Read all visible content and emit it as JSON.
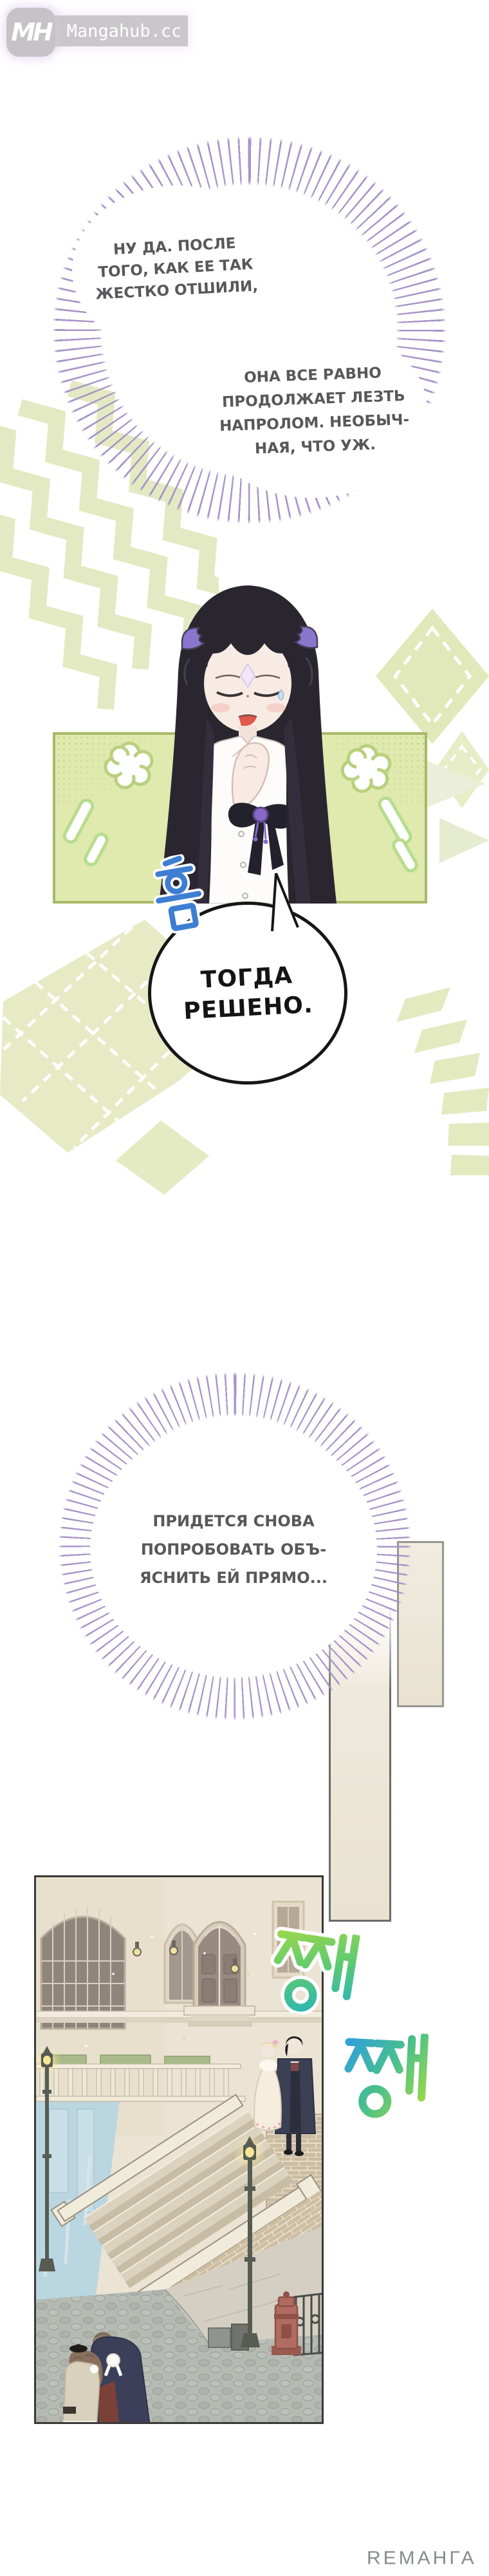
{
  "site_watermark": {
    "initials": "MH",
    "domain": "Mangahub.cc"
  },
  "bubbles": {
    "b1": {
      "lines": [
        "НУ ДА. ПОСЛЕ",
        "ТОГО, КАК ЕЕ ТАК",
        "ЖЕСТКО ОТШИЛИ,"
      ]
    },
    "b2": {
      "lines": [
        "ОНА ВСЕ РАВНО",
        "ПРОДОЛЖАЕТ ЛЕЗТЬ",
        "НАПРОЛОМ. НЕОБЫЧ-",
        "НАЯ, ЧТО УЖ."
      ]
    },
    "b3": {
      "lines": [
        "ТОГДА",
        "РЕШЕНО."
      ]
    },
    "b4": {
      "lines": [
        "ПРИДЕТСЯ СНОВА",
        "ПОПРОБОВАТЬ ОБЪ-",
        "ЯСНИТЬ ЕЙ ПРЯМО..."
      ]
    }
  },
  "sfx": {
    "hmm": "흠",
    "clink1": "쨍",
    "clink2": "쨍"
  },
  "footer_watermark": {
    "text": "RЕМАНГА"
  },
  "colors": {
    "halo_purple": "#a48fc5",
    "bubble_text_gray": "#58585a",
    "decision_text_black": "#161616",
    "pattern_green": "#e3eac3",
    "frame_green": "#a6ba67",
    "panel_bg_green": "#e0e9ae",
    "sfx_hmm_blue": "#3e7ed2",
    "sfx_clink_lime": "#a6d94a",
    "sfx_clink_teal": "#2fb7b0",
    "sfx_clink_blue": "#2f9fdc",
    "canal_water_blue": "#b9d6e1",
    "brick_tan": "#cdbda1",
    "postbox_red": "#b26b60",
    "beige_panel": "#efe9db",
    "footer_gray": "#888b8f",
    "logo_gray": "#c6c3c6"
  }
}
